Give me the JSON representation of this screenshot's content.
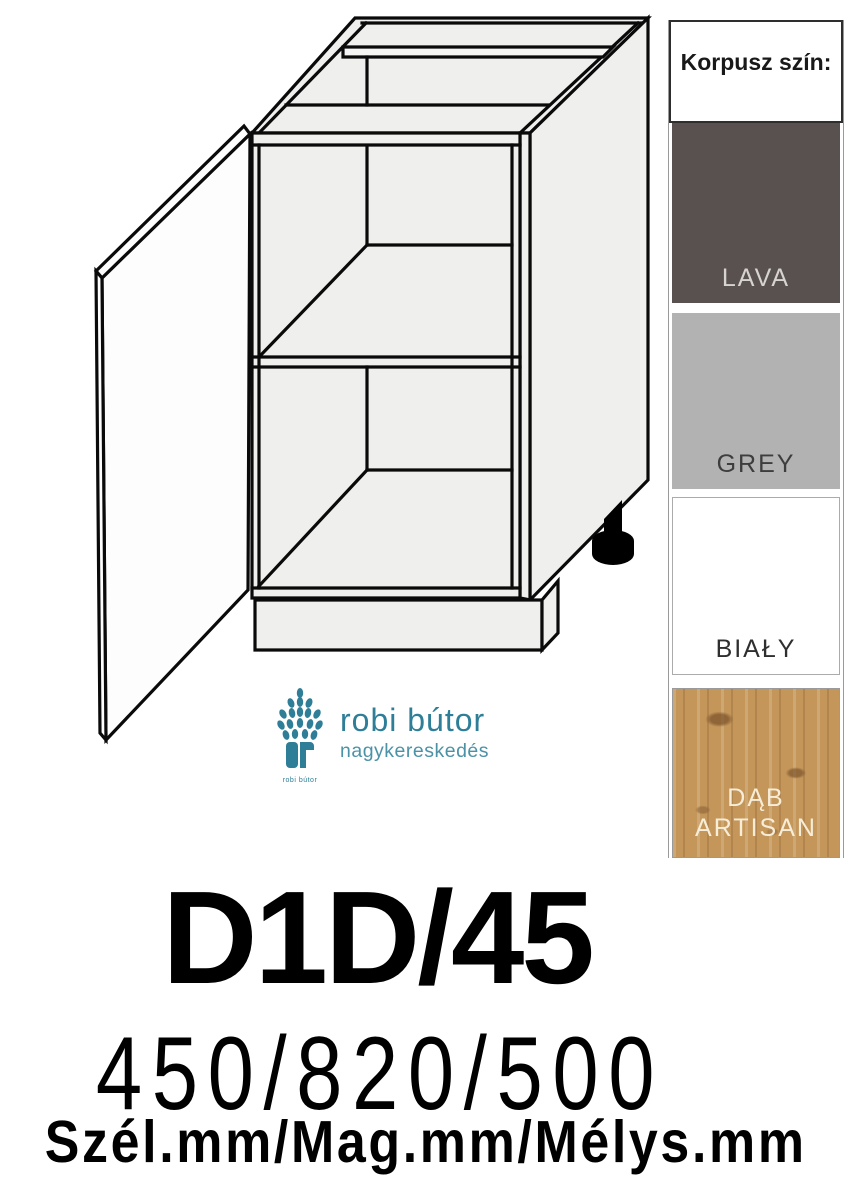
{
  "product": {
    "code": "D1D/45",
    "dimensions": "450/820/500",
    "dimensions_caption": "Szél.mm/Mag.mm/Mélys.mm"
  },
  "color_panel": {
    "header": "Korpusz szín:",
    "swatches": [
      {
        "name": "LAVA",
        "hex": "#585150",
        "text_color": "#d7d3d0"
      },
      {
        "name": "GREY",
        "hex": "#b2b2b2",
        "text_color": "#3d3d3d"
      },
      {
        "name": "BIAŁY",
        "hex": "#ffffff",
        "text_color": "#2f2f2f"
      },
      {
        "name": "DĄB ARTISAN",
        "hex": "#c49659",
        "text_color": "#f6edd9"
      }
    ]
  },
  "logo": {
    "name": "robi bútor",
    "subtitle": "nagykereskedés",
    "caption": "robi bútor",
    "brand_color": "#2e7e97",
    "subtitle_color": "#4b92a7"
  },
  "illustration": {
    "description": "line drawing of base cabinet with one open door, one shelf, plinth and adjustable foot",
    "line_color": "#0a0a0a",
    "face_color": "#efefee"
  }
}
